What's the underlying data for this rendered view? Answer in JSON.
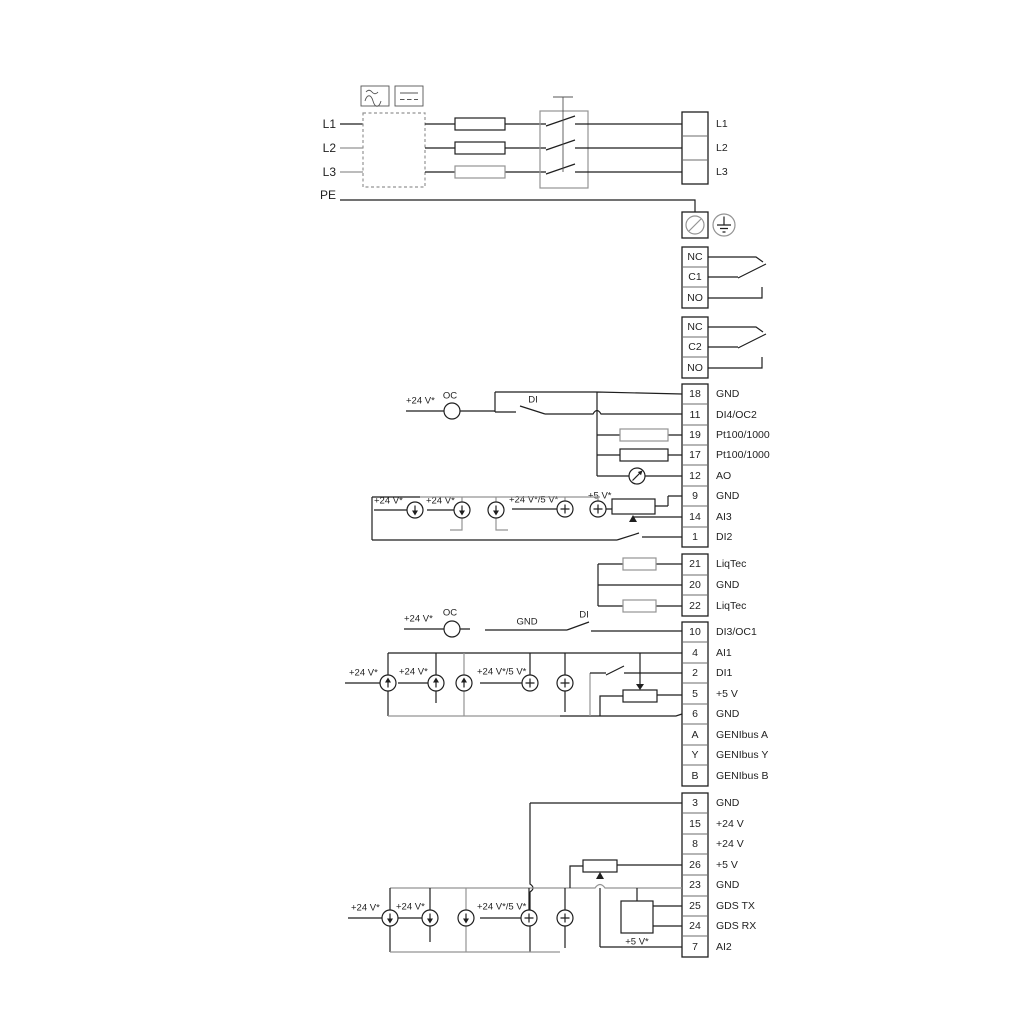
{
  "mains": {
    "input_labels": [
      "L1",
      "L2",
      "L3",
      "PE"
    ],
    "output_labels": [
      "L1",
      "L2",
      "L3"
    ]
  },
  "relay1": {
    "rows": [
      "NC",
      "C1",
      "NO"
    ]
  },
  "relay2": {
    "rows": [
      "NC",
      "C2",
      "NO"
    ]
  },
  "io1": {
    "rows": [
      {
        "num": "18",
        "label": "GND"
      },
      {
        "num": "11",
        "label": "DI4/OC2"
      },
      {
        "num": "19",
        "label": "Pt100/1000"
      },
      {
        "num": "17",
        "label": "Pt100/1000"
      },
      {
        "num": "12",
        "label": "AO"
      },
      {
        "num": "9",
        "label": "GND"
      },
      {
        "num": "14",
        "label": "AI3"
      },
      {
        "num": "1",
        "label": "DI2"
      }
    ]
  },
  "io2": {
    "rows": [
      {
        "num": "21",
        "label": "LiqTec"
      },
      {
        "num": "20",
        "label": "GND"
      },
      {
        "num": "22",
        "label": "LiqTec"
      }
    ]
  },
  "io3": {
    "rows": [
      {
        "num": "10",
        "label": "DI3/OC1"
      },
      {
        "num": "4",
        "label": "AI1"
      },
      {
        "num": "2",
        "label": "DI1"
      },
      {
        "num": "5",
        "label": "+5 V"
      },
      {
        "num": "6",
        "label": "GND"
      },
      {
        "num": "A",
        "label": "GENIbus A"
      },
      {
        "num": "Y",
        "label": "GENIbus Y"
      },
      {
        "num": "B",
        "label": "GENIbus B"
      }
    ]
  },
  "io4": {
    "rows": [
      {
        "num": "3",
        "label": "GND"
      },
      {
        "num": "15",
        "label": "+24 V"
      },
      {
        "num": "8",
        "label": "+24 V"
      },
      {
        "num": "26",
        "label": "+5 V"
      },
      {
        "num": "23",
        "label": "GND"
      },
      {
        "num": "25",
        "label": "GDS TX"
      },
      {
        "num": "24",
        "label": "GDS RX"
      },
      {
        "num": "7",
        "label": "AI2"
      }
    ]
  },
  "ann": {
    "g1": {
      "v24": "+24 V*",
      "oc": "OC",
      "di": "DI"
    },
    "g2": {
      "v24a": "+24 V*",
      "v24b": "+24 V*",
      "v245": "+24 V*/5 V*",
      "v5": "+5 V*"
    },
    "g3": {
      "v24": "+24 V*",
      "oc": "OC",
      "gnd": "GND",
      "di": "DI"
    },
    "g4": {
      "v24a": "+24 V*",
      "v24b": "+24 V*",
      "v245": "+24 V*/5 V*"
    },
    "g5": {
      "v24a": "+24 V*",
      "v24b": "+24 V*",
      "v245": "+24 V*/5 V*",
      "v5": "+5 V*"
    }
  },
  "colors": {
    "wire": "#1f1f1f",
    "gray": "#949494",
    "bg": "#ffffff"
  }
}
